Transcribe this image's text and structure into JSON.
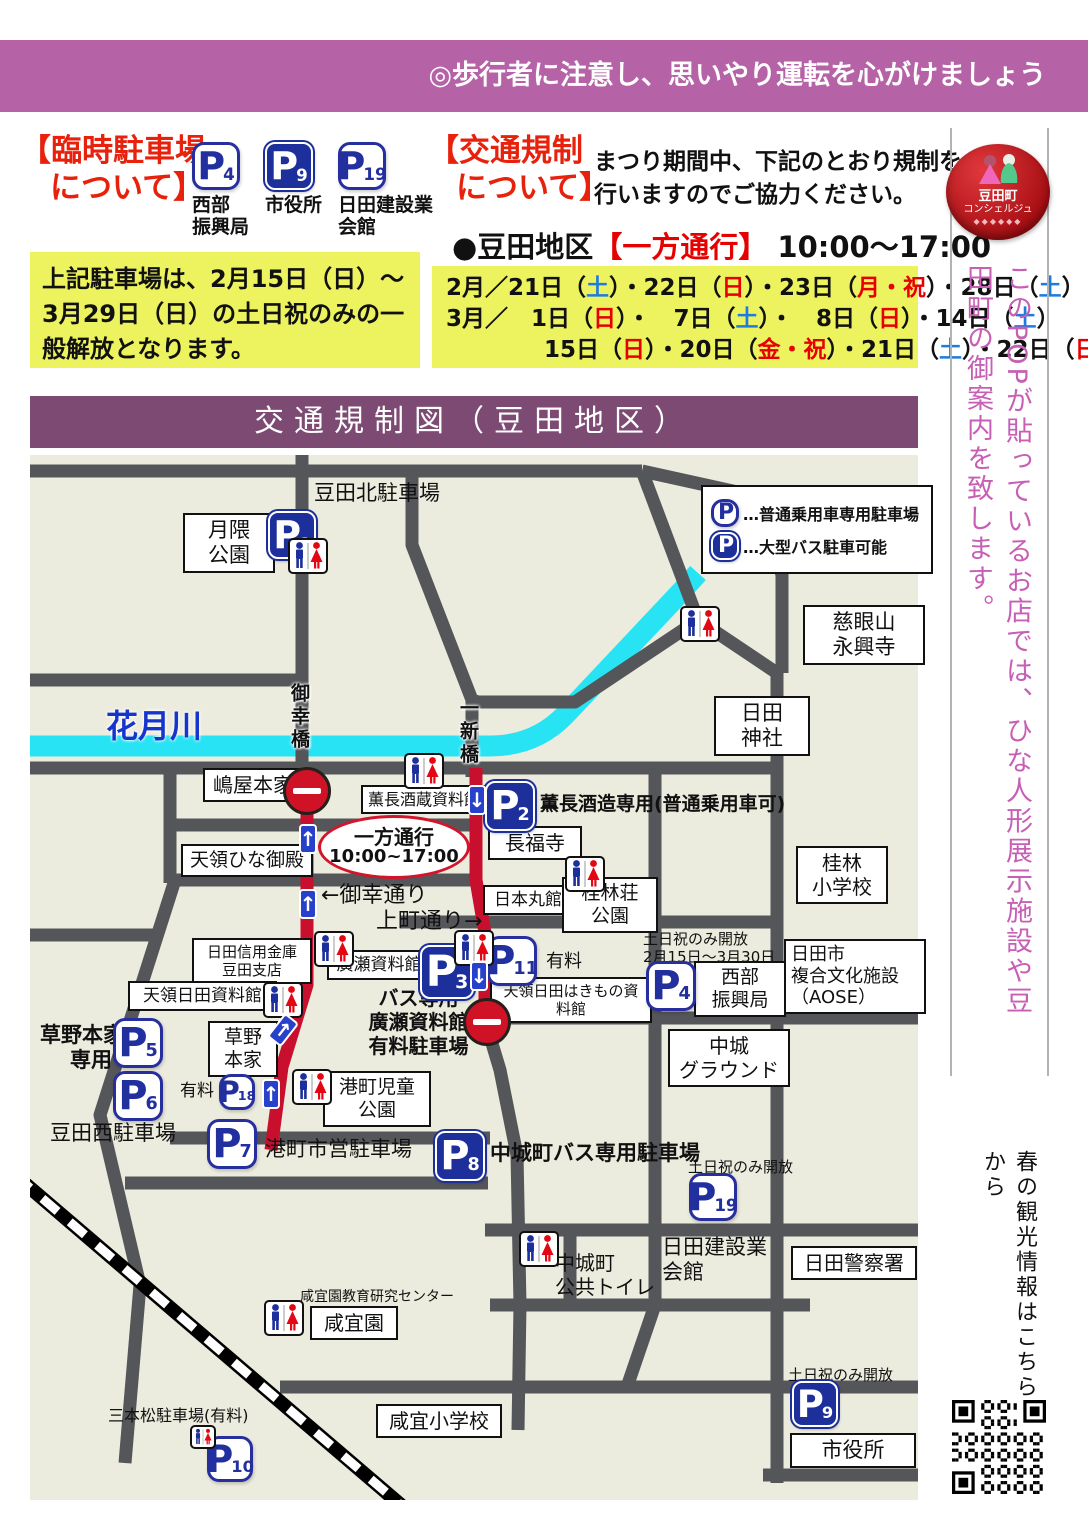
{
  "colors": {
    "banner_purple": "#b562a6",
    "title_purple": "#7d4a73",
    "accent_red": "#e8210c",
    "highlight_yellow": "#edf35f",
    "map_bg": "#ececde",
    "road_gray": "#55565a",
    "oneway_red": "#c8102e",
    "river_cyan": "#28e3f4",
    "parking_blue": "#1d2f9b",
    "day_sat_blue": "#1e7ce0",
    "day_sun_red": "#e60000",
    "sidebar_pink": "#c75fb5"
  },
  "top_banner": "◎歩行者に注意し、思いやり運転を心がけましょう",
  "header": {
    "parking": {
      "title1": "【臨時駐車場",
      "title2": "について】",
      "lots": [
        {
          "n": "4",
          "s": "white",
          "label": [
            "西部",
            "振興局"
          ]
        },
        {
          "n": "9",
          "s": "blue",
          "label": [
            "市役所"
          ]
        },
        {
          "n": "19",
          "s": "white",
          "label": [
            "日田建設業",
            "会館"
          ]
        }
      ],
      "note": "上記駐車場は、2月15日（日）～3月29日（日）の土日祝のみの一般解放となります。"
    },
    "regulation": {
      "title1": "【交通規制",
      "title2": "について】",
      "desc1": "まつり期間中、下記のとおり規制を",
      "desc2": "行いますのでご協力ください。",
      "subtitle": [
        {
          "t": "●豆田地区",
          "c": "k"
        },
        {
          "t": "【一方通行】",
          "c": "r"
        },
        {
          "t": " 10:00～17:00",
          "c": "k"
        }
      ],
      "date_lines": [
        {
          "indent": 0,
          "segs": [
            {
              "t": "2月／21日（",
              "c": "k"
            },
            {
              "t": "土",
              "c": "b"
            },
            {
              "t": "）・22日（",
              "c": "k"
            },
            {
              "t": "日",
              "c": "r"
            },
            {
              "t": "）・23日（",
              "c": "k"
            },
            {
              "t": "月・祝",
              "c": "r"
            },
            {
              "t": "）・28日（",
              "c": "k"
            },
            {
              "t": "土",
              "c": "b"
            },
            {
              "t": "）",
              "c": "k"
            }
          ]
        },
        {
          "indent": 0,
          "segs": [
            {
              "t": "3月／　1日（",
              "c": "k"
            },
            {
              "t": "日",
              "c": "r"
            },
            {
              "t": "）・　7日（",
              "c": "k"
            },
            {
              "t": "土",
              "c": "b"
            },
            {
              "t": "）・　8日（",
              "c": "k"
            },
            {
              "t": "日",
              "c": "r"
            },
            {
              "t": "）・14日（",
              "c": "k"
            },
            {
              "t": "土",
              "c": "b"
            },
            {
              "t": "）",
              "c": "k"
            }
          ]
        },
        {
          "indent": 2,
          "segs": [
            {
              "t": "15日（",
              "c": "k"
            },
            {
              "t": "日",
              "c": "r"
            },
            {
              "t": "）・20日（",
              "c": "k"
            },
            {
              "t": "金・祝",
              "c": "r"
            },
            {
              "t": "）・21日（",
              "c": "k"
            },
            {
              "t": "土",
              "c": "b"
            },
            {
              "t": "）・22日（",
              "c": "k"
            },
            {
              "t": "日",
              "c": "r"
            },
            {
              "t": "）",
              "c": "k"
            }
          ]
        }
      ]
    }
  },
  "map": {
    "title": "交通規制図（豆田地区）",
    "legend": [
      {
        "s": "white",
        "t": "…普通乗用車専用駐車場"
      },
      {
        "s": "blue",
        "t": "…大型バス駐車可能"
      }
    ],
    "river_label": "花月川",
    "bubble": {
      "l1": "一方通行",
      "l2": "10:00~17:00"
    },
    "bridges": [
      {
        "text": "御幸橋",
        "x": 256,
        "y": 228
      },
      {
        "text": "一新橋",
        "x": 425,
        "y": 243
      }
    ],
    "labels": [
      {
        "id": "tsukikuma-park",
        "lines": [
          "月隈",
          "公園"
        ],
        "x": 153,
        "y": 58,
        "w": 78,
        "fs": 21,
        "box": true
      },
      {
        "id": "mameda-kita-lot",
        "lines": [
          "豆田北駐車場"
        ],
        "x": 284,
        "y": 26,
        "fs": 21
      },
      {
        "id": "jigenzan-eikoji",
        "lines": [
          "慈眼山",
          "永興寺"
        ],
        "x": 773,
        "y": 150,
        "w": 108,
        "fs": 21,
        "box": true
      },
      {
        "id": "hita-jinja",
        "lines": [
          "日田",
          "神社"
        ],
        "x": 684,
        "y": 241,
        "w": 82,
        "fs": 21,
        "box": true
      },
      {
        "id": "kagetsu-river",
        "lines": [
          "花月川"
        ],
        "x": 76,
        "y": 252,
        "fs": 32,
        "bold": true,
        "color": "blue"
      },
      {
        "id": "shimaya-honke",
        "lines": [
          "嶋屋本家"
        ],
        "x": 173,
        "y": 313,
        "w": 86,
        "fs": 20,
        "box": true
      },
      {
        "id": "kuncho-sakagura-museum",
        "lines": [
          "薫長酒蔵資料館"
        ],
        "x": 331,
        "y": 330,
        "w": 112,
        "fs": 16,
        "box": true
      },
      {
        "id": "kuncho-parking-note",
        "lines": [
          "薫長酒造専用(普通乗用車可)"
        ],
        "x": 510,
        "y": 338,
        "fs": 19,
        "bold": true
      },
      {
        "id": "chofukuji",
        "lines": [
          "長福寺"
        ],
        "x": 458,
        "y": 371,
        "w": 80,
        "fs": 20,
        "box": true
      },
      {
        "id": "tenryo-hina-goten",
        "lines": [
          "天領ひな御殿"
        ],
        "x": 151,
        "y": 389,
        "w": 118,
        "fs": 19,
        "box": true
      },
      {
        "id": "miyuki-street",
        "lines": [
          "←御幸通り"
        ],
        "x": 291,
        "y": 428,
        "fs": 22
      },
      {
        "id": "uwamachi-street",
        "lines": [
          "上町通り→"
        ],
        "x": 346,
        "y": 454,
        "fs": 22
      },
      {
        "id": "nihonmarukan",
        "lines": [
          "日本丸館"
        ],
        "x": 453,
        "y": 430,
        "w": 76,
        "fs": 17,
        "box": true
      },
      {
        "id": "keirinso-park",
        "lines": [
          "桂林荘",
          "公園"
        ],
        "x": 532,
        "y": 422,
        "w": 82,
        "fs": 19,
        "box": true
      },
      {
        "id": "keirin-elementary",
        "lines": [
          "桂林",
          "小学校"
        ],
        "x": 766,
        "y": 391,
        "w": 78,
        "fs": 20,
        "box": true
      },
      {
        "id": "hita-shinkin",
        "lines": [
          "日田信用金庫",
          "豆田支店"
        ],
        "x": 162,
        "y": 483,
        "w": 106,
        "fs": 15,
        "box": true
      },
      {
        "id": "hirose-museum",
        "lines": [
          "廣瀬資料館"
        ],
        "x": 297,
        "y": 495,
        "w": 90,
        "fs": 17,
        "box": true
      },
      {
        "id": "p11-fee",
        "lines": [
          "有料"
        ],
        "x": 516,
        "y": 496,
        "fs": 18
      },
      {
        "id": "hakimono-museum",
        "lines": [
          "天領日田はきもの資料館"
        ],
        "x": 460,
        "y": 522,
        "w": 148,
        "fs": 15,
        "box": true
      },
      {
        "id": "tenryo-hita-museum",
        "lines": [
          "天領日田資料館"
        ],
        "x": 98,
        "y": 526,
        "w": 135,
        "fs": 17,
        "box": true
      },
      {
        "id": "bus-only-lot",
        "lines": [
          "バス専用",
          "廣瀬資料館",
          "有料駐車場"
        ],
        "x": 336,
        "y": 531,
        "w": 105,
        "fs": 20,
        "bold": true,
        "align": "center"
      },
      {
        "id": "p4-note",
        "lines": [
          "土日祝のみ開放",
          "2月15日～3月30日"
        ],
        "x": 613,
        "y": 475,
        "fs": 15
      },
      {
        "id": "seibu-shinkokyoku",
        "lines": [
          "西部",
          "振興局"
        ],
        "x": 664,
        "y": 506,
        "w": 78,
        "fs": 19,
        "box": true
      },
      {
        "id": "aose",
        "lines": [
          "日田市",
          "複合文化施設",
          "（AOSE）"
        ],
        "x": 754,
        "y": 484,
        "w": 128,
        "fs": 18,
        "box": true,
        "align": "left"
      },
      {
        "id": "nakajo-ground",
        "lines": [
          "中城",
          "グラウンド"
        ],
        "x": 638,
        "y": 574,
        "w": 108,
        "fs": 20,
        "box": true
      },
      {
        "id": "kusano-senyo",
        "lines": [
          "草野本家",
          "専用"
        ],
        "x": 10,
        "y": 568,
        "w": 72,
        "fs": 21,
        "bold": true,
        "align": "right"
      },
      {
        "id": "kusano-honke",
        "lines": [
          "草野",
          "本家"
        ],
        "x": 178,
        "y": 566,
        "w": 56,
        "fs": 19,
        "box": true
      },
      {
        "id": "p18-fee",
        "lines": [
          "有料"
        ],
        "x": 150,
        "y": 626,
        "fs": 17
      },
      {
        "id": "mameda-nishi-lot",
        "lines": [
          "豆田西駐車場"
        ],
        "x": 20,
        "y": 666,
        "fs": 21
      },
      {
        "id": "minatomachi-kids-park",
        "lines": [
          "港町児童",
          "公園"
        ],
        "x": 293,
        "y": 616,
        "w": 94,
        "fs": 19,
        "box": true
      },
      {
        "id": "minatomachi-city-lot",
        "lines": [
          "港町市営駐車場"
        ],
        "x": 235,
        "y": 682,
        "fs": 21
      },
      {
        "id": "nakajo-bus-lot",
        "lines": [
          "中城町バス専用駐車場"
        ],
        "x": 460,
        "y": 686,
        "fs": 21,
        "bold": true
      },
      {
        "id": "p19-note",
        "lines": [
          "土日祝のみ開放"
        ],
        "x": 658,
        "y": 703,
        "fs": 15
      },
      {
        "id": "kensetsu-kaikan",
        "lines": [
          "日田建設業",
          "会館"
        ],
        "x": 632,
        "y": 780,
        "fs": 21
      },
      {
        "id": "hita-police",
        "lines": [
          "日田警察署"
        ],
        "x": 761,
        "y": 791,
        "w": 112,
        "fs": 20,
        "box": true
      },
      {
        "id": "nakajo-public-toilet",
        "lines": [
          "中城町",
          "公共トイレ"
        ],
        "x": 525,
        "y": 796,
        "fs": 20
      },
      {
        "id": "kangien-center",
        "lines": [
          "咸宜園教育研究センター"
        ],
        "x": 270,
        "y": 834,
        "fs": 14
      },
      {
        "id": "kangien",
        "lines": [
          "咸宜園"
        ],
        "x": 280,
        "y": 851,
        "w": 74,
        "fs": 20,
        "box": true
      },
      {
        "id": "kangi-elementary",
        "lines": [
          "咸宜小学校"
        ],
        "x": 346,
        "y": 949,
        "w": 112,
        "fs": 20,
        "box": true
      },
      {
        "id": "sanbonmatsu-lot",
        "lines": [
          "三本松駐車場(有料)"
        ],
        "x": 78,
        "y": 951,
        "fs": 16
      },
      {
        "id": "p9-note",
        "lines": [
          "土日祝のみ開放"
        ],
        "x": 758,
        "y": 911,
        "fs": 15
      },
      {
        "id": "city-hall",
        "lines": [
          "市役所"
        ],
        "x": 760,
        "y": 978,
        "w": 112,
        "fs": 21,
        "box": true
      }
    ],
    "parkings": [
      {
        "n": "1",
        "s": "blue",
        "x": 238,
        "y": 56,
        "sz": 48
      },
      {
        "n": "2",
        "s": "blue",
        "x": 455,
        "y": 326,
        "sz": 50
      },
      {
        "n": "3",
        "s": "blue",
        "x": 390,
        "y": 490,
        "sz": 54
      },
      {
        "n": "4",
        "s": "white",
        "x": 616,
        "y": 506,
        "sz": 50
      },
      {
        "n": "5",
        "s": "white",
        "x": 83,
        "y": 563,
        "sz": 50
      },
      {
        "n": "6",
        "s": "white",
        "x": 83,
        "y": 616,
        "sz": 50
      },
      {
        "n": "7",
        "s": "white",
        "x": 177,
        "y": 664,
        "sz": 50
      },
      {
        "n": "8",
        "s": "blue",
        "x": 405,
        "y": 676,
        "sz": 50
      },
      {
        "n": "9",
        "s": "blue",
        "x": 762,
        "y": 926,
        "sz": 46
      },
      {
        "n": "10",
        "s": "white",
        "x": 177,
        "y": 981,
        "sz": 46
      },
      {
        "n": "11",
        "s": "white",
        "x": 457,
        "y": 481,
        "sz": 50
      },
      {
        "n": "18",
        "s": "white",
        "x": 189,
        "y": 619,
        "sz": 36
      },
      {
        "n": "19",
        "s": "white",
        "x": 659,
        "y": 718,
        "sz": 48
      }
    ],
    "toilets": [
      {
        "x": 258,
        "y": 83
      },
      {
        "x": 650,
        "y": 151
      },
      {
        "x": 374,
        "y": 298
      },
      {
        "x": 535,
        "y": 401
      },
      {
        "x": 284,
        "y": 476
      },
      {
        "x": 424,
        "y": 475
      },
      {
        "x": 233,
        "y": 527
      },
      {
        "x": 262,
        "y": 614
      },
      {
        "x": 489,
        "y": 776
      },
      {
        "x": 234,
        "y": 845
      },
      {
        "x": 160,
        "y": 970,
        "sm": 1
      }
    ],
    "arrows": [
      {
        "x": 269,
        "y": 369,
        "d": "up"
      },
      {
        "x": 269,
        "y": 434,
        "d": "up"
      },
      {
        "x": 232,
        "y": 624,
        "d": "up"
      },
      {
        "x": 244,
        "y": 560,
        "d": "ne"
      },
      {
        "x": 438,
        "y": 330,
        "d": "down"
      },
      {
        "x": 440,
        "y": 506,
        "d": "down"
      }
    ],
    "no_entry": [
      {
        "x": 253,
        "y": 312
      },
      {
        "x": 433,
        "y": 543
      }
    ]
  },
  "sidebar": {
    "badge_line1": "豆田町",
    "badge_line2": "コンシェルジュ",
    "badge_deco": "◆◆◆◆◆◆",
    "pop_text": "このPOPが貼っているお店では、ひな人形展示施設や豆田町の御案内を致します。",
    "qr_caption": "春の観光情報はこちらから"
  }
}
